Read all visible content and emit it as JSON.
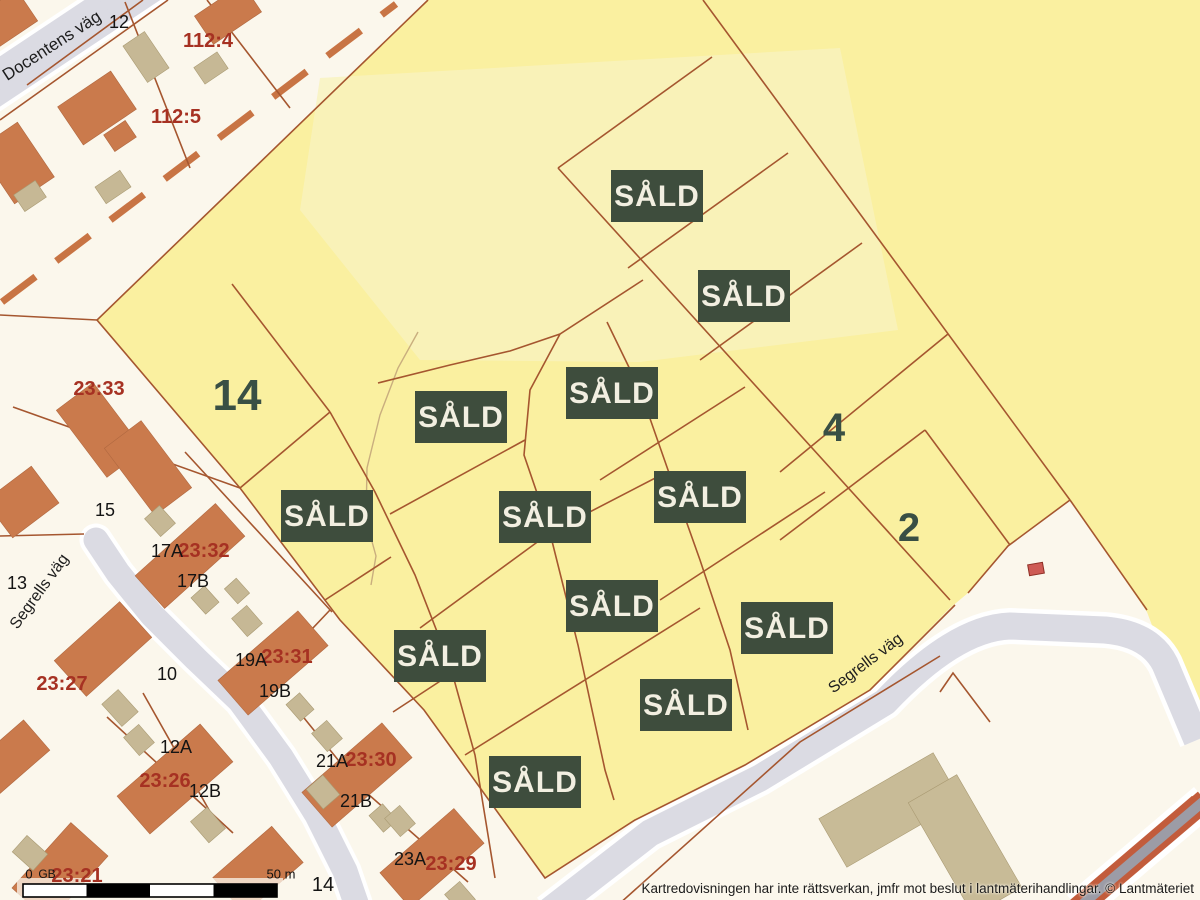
{
  "streets": {
    "docentens": "Docentens väg",
    "segrells_left": "Segrells väg",
    "segrells_bottom": "Segrells väg"
  },
  "plot_numbers": {
    "n14": "14",
    "n4": "4",
    "n2": "2"
  },
  "sold_badges": [
    {
      "label": "SÅLD"
    },
    {
      "label": "SÅLD"
    },
    {
      "label": "SÅLD"
    },
    {
      "label": "SÅLD"
    },
    {
      "label": "SÅLD"
    },
    {
      "label": "SÅLD"
    },
    {
      "label": "SÅLD"
    },
    {
      "label": "SÅLD"
    },
    {
      "label": "SÅLD"
    },
    {
      "label": "SÅLD"
    },
    {
      "label": "SÅLD"
    },
    {
      "label": "SÅLD"
    }
  ],
  "parcel_labels": {
    "p112_4": "112:4",
    "p112_5": "112:5",
    "p23_33": "23:33",
    "p23_32": "23:32",
    "p23_31": "23:31",
    "p23_30": "23:30",
    "p23_29": "23:29",
    "p23_27": "23:27",
    "p23_26": "23:26",
    "p23_21": "23:21"
  },
  "house_numbers": {
    "h12": "12",
    "h15": "15",
    "h13": "13",
    "h17a": "17A",
    "h17b": "17B",
    "h10": "10",
    "h19a": "19A",
    "h19b": "19B",
    "h12a": "12A",
    "h12b": "12B",
    "h21a": "21A",
    "h21b": "21B",
    "h23a": "23A",
    "h14": "14",
    "gb": "GB"
  },
  "scale_bar": {
    "start": "0",
    "end": "50 m"
  },
  "footer": {
    "disclaimer": "Kartredovisningen har inte rättsverkan, jmfr mot beslut i lantmäterihandlingar. © Lantmäteriet"
  },
  "colors": {
    "background": "#FBF7EC",
    "area_yellow": "#FAF0A0",
    "area_yellow_light": "#F9F3BE",
    "parcel_line": "#A5562F",
    "road_fill": "#DBDBE3",
    "road_casing": "#FFFFFF",
    "building_orange": "#CA7A4C",
    "building_tan": "#C6B895",
    "sold_badge_bg": "#3E4D3D",
    "sold_badge_text": "#F2EFE1",
    "parcel_label_red": "#A63122",
    "plot_number_green": "#394F44",
    "boundary_dash_orange": "#C87444",
    "stripe_road_orange": "#C25C3C",
    "stripe_road_gray": "#9C9CA6",
    "red_marker": "#CE5B55"
  }
}
